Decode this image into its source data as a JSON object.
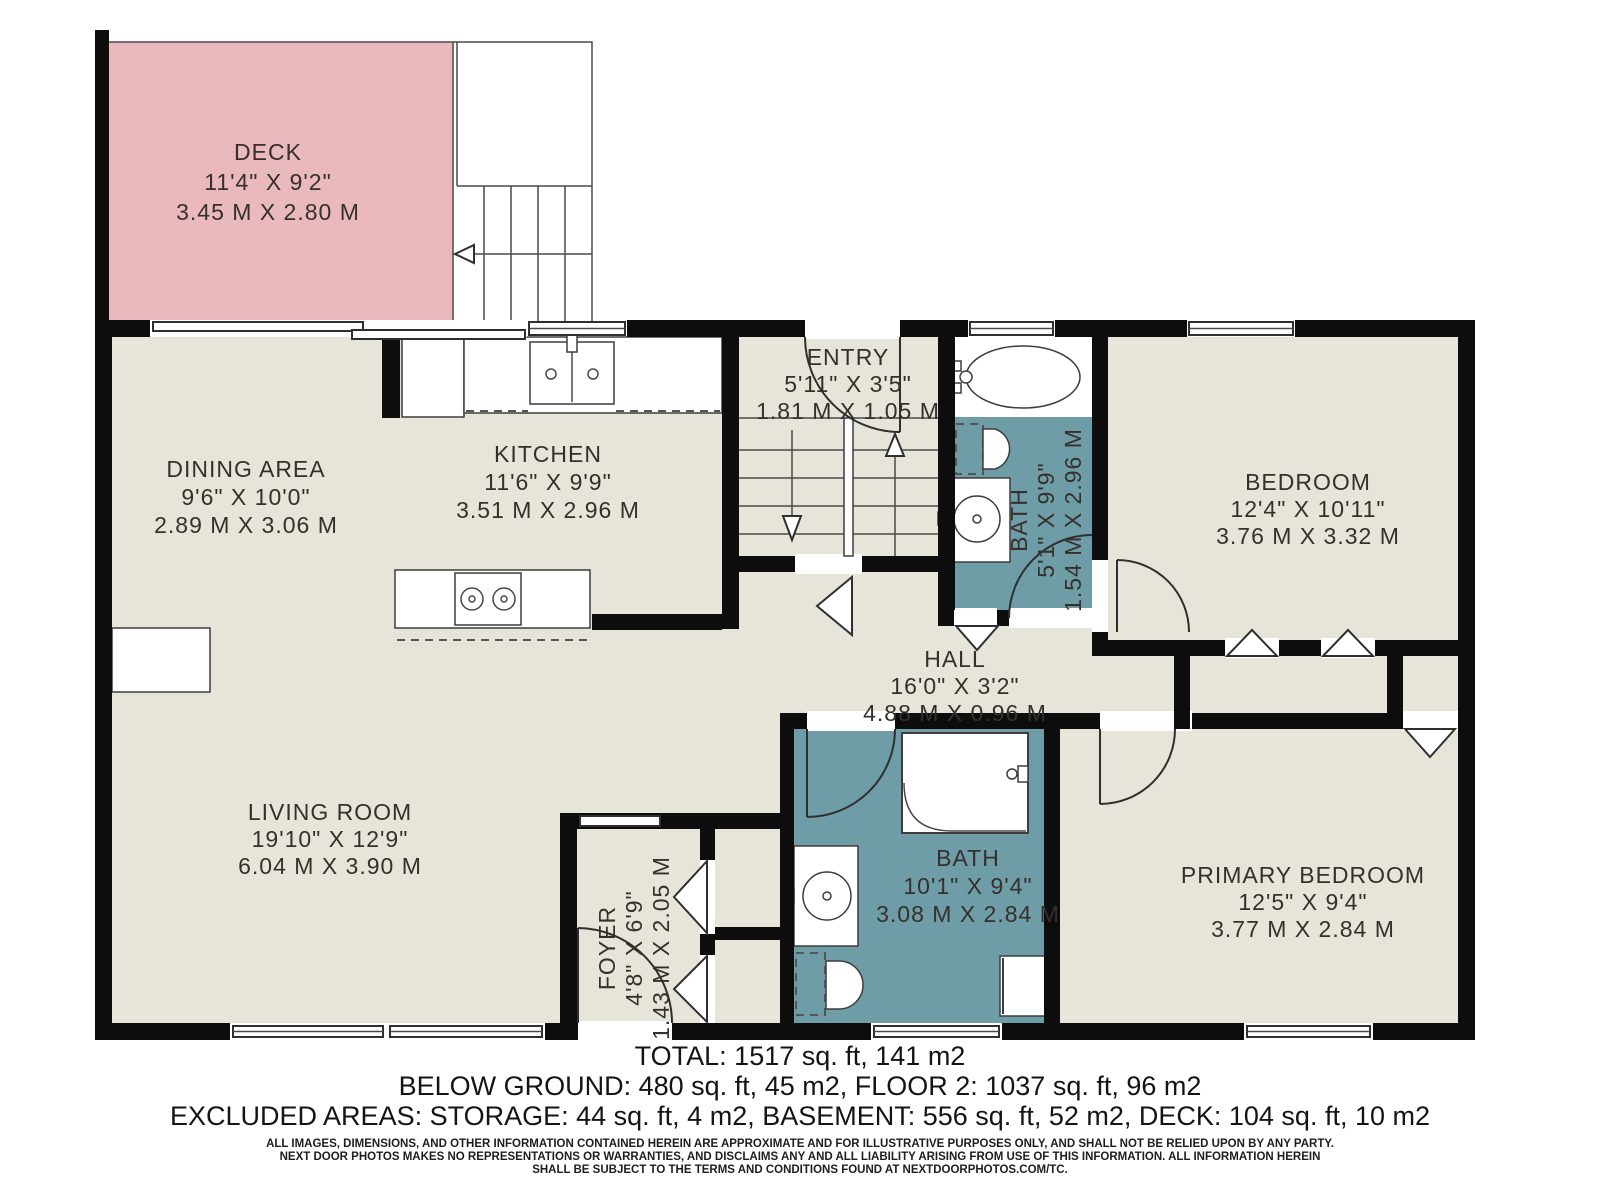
{
  "colors": {
    "wall": "#0d0d0d",
    "floor": "#e7e5d9",
    "deck": "#e9b9bd",
    "bath": "#6f9da7",
    "label_text": "#35302c"
  },
  "rooms": {
    "deck": {
      "name": "DECK",
      "imperial": "11'4\" X 9'2\"",
      "metric": "3.45 M X 2.80 M"
    },
    "dining": {
      "name": "DINING AREA",
      "imperial": "9'6\" X 10'0\"",
      "metric": "2.89 M X 3.06 M"
    },
    "kitchen": {
      "name": "KITCHEN",
      "imperial": "11'6\" X 9'9\"",
      "metric": "3.51 M X 2.96 M"
    },
    "entry": {
      "name": "ENTRY",
      "imperial": "5'11\" X 3'5\"",
      "metric": "1.81 M X 1.05 M"
    },
    "bath_upper": {
      "name": "BATH",
      "imperial": "5'1\" X 9'9\"",
      "metric": "1.54 M X 2.96 M"
    },
    "bedroom": {
      "name": "BEDROOM",
      "imperial": "12'4\" X 10'11\"",
      "metric": "3.76 M X 3.32 M"
    },
    "hall": {
      "name": "HALL",
      "imperial": "16'0\" X 3'2\"",
      "metric": "4.88 M X 0.96 M"
    },
    "living": {
      "name": "LIVING ROOM",
      "imperial": "19'10\" X 12'9\"",
      "metric": "6.04 M X 3.90 M"
    },
    "foyer": {
      "name": "FOYER",
      "imperial": "4'8\" X 6'9\"",
      "metric": "1.43 M X 2.05 M"
    },
    "bath_main": {
      "name": "BATH",
      "imperial": "10'1\" X 9'4\"",
      "metric": "3.08 M X 2.84 M"
    },
    "primary": {
      "name": "PRIMARY BEDROOM",
      "imperial": "12'5\" X 9'4\"",
      "metric": "3.77 M X 2.84 M"
    }
  },
  "summary": {
    "total": "TOTAL: 1517 sq. ft, 141 m2",
    "below_ground": "BELOW GROUND: 480 sq. ft, 45 m2, FLOOR 2: 1037 sq. ft, 96 m2",
    "excluded": "EXCLUDED AREAS: STORAGE: 44 sq. ft, 4 m2, BASEMENT: 556 sq. ft, 52 m2, DECK: 104 sq. ft, 10 m2"
  },
  "disclaimer": {
    "line1": "ALL IMAGES, DIMENSIONS, AND OTHER INFORMATION CONTAINED HEREIN ARE APPROXIMATE AND FOR ILLUSTRATIVE PURPOSES ONLY, AND SHALL NOT BE RELIED UPON BY ANY PARTY.",
    "line2": "NEXT DOOR PHOTOS MAKES NO REPRESENTATIONS OR WARRANTIES, AND DISCLAIMS ANY AND ALL LIABILITY ARISING FROM USE OF THIS INFORMATION. ALL INFORMATION HEREIN",
    "line3": "SHALL BE SUBJECT TO THE TERMS AND CONDITIONS FOUND AT NEXTDOORPHOTOS.COM/TC."
  }
}
